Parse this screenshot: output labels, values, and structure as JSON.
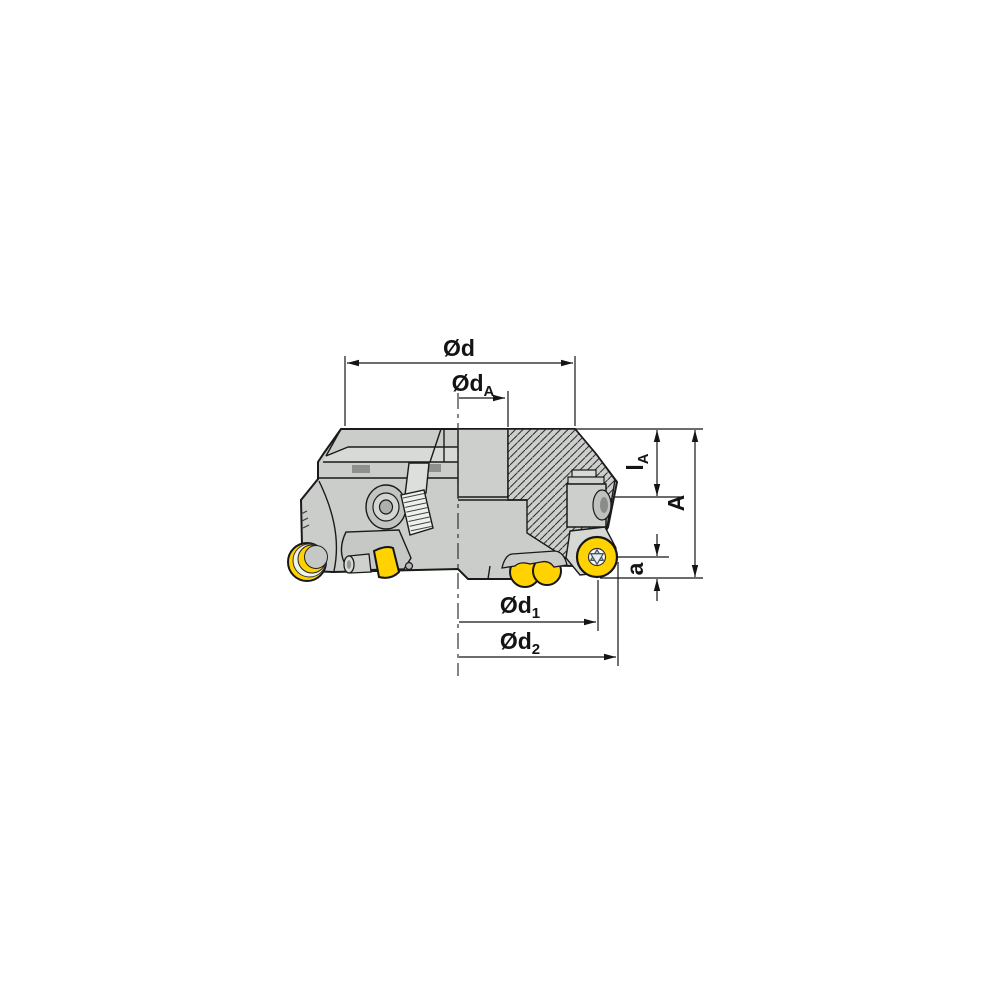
{
  "diagram": {
    "type": "technical-drawing",
    "subject": "indexable face milling cutter with round inserts, half-section side view with dimension annotations",
    "dimension_labels": {
      "d": {
        "base": "Ød",
        "sub": ""
      },
      "dA": {
        "base": "Ød",
        "sub": "A"
      },
      "d1": {
        "base": "Ød",
        "sub": "1"
      },
      "d2": {
        "base": "Ød",
        "sub": "2"
      },
      "lA": {
        "base": "l",
        "sub": "A"
      },
      "A": {
        "base": "A",
        "sub": ""
      },
      "a": {
        "base": "a",
        "sub": ""
      }
    },
    "colors": {
      "insert_yellow": "#FFD200",
      "body_gray": "#CBCDCA",
      "outline": "#1A1A1A",
      "background": "#FFFFFF"
    }
  }
}
